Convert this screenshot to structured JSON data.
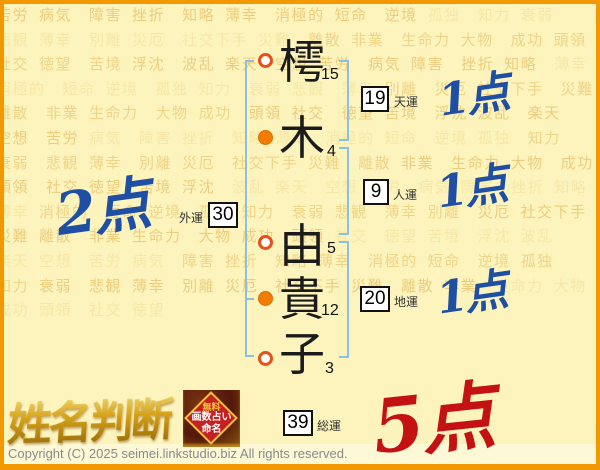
{
  "page": {
    "title": "姓名判断",
    "copyright": "Copyright (C) 2025 seimei.linkstudio.biz All rights reserved."
  },
  "name": {
    "chars": [
      {
        "char": "樗",
        "strokes": "15",
        "mark": "open",
        "group": "surname"
      },
      {
        "char": "木",
        "strokes": "4",
        "mark": "filled",
        "group": "surname"
      },
      {
        "char": "由",
        "strokes": "5",
        "mark": "open",
        "group": "given"
      },
      {
        "char": "貴",
        "strokes": "12",
        "mark": "filled",
        "group": "given"
      },
      {
        "char": "子",
        "strokes": "3",
        "mark": "open",
        "group": "given"
      }
    ]
  },
  "fortunes": [
    {
      "label": "天運",
      "value": "19",
      "score": "1点",
      "score_color": "blue"
    },
    {
      "label": "人運",
      "value": "9",
      "score": "1点",
      "score_color": "blue"
    },
    {
      "label": "外運",
      "value": "30",
      "score": "2点",
      "score_color": "blue"
    },
    {
      "label": "地運",
      "value": "20",
      "score": "1点",
      "score_color": "blue"
    },
    {
      "label": "総運",
      "value": "39",
      "score": "5点",
      "score_color": "red"
    }
  ],
  "badge": {
    "lines": [
      "無料",
      "画数占い",
      "命名"
    ]
  },
  "background_words": [
    "苦労",
    "病気",
    "障害",
    "挫折",
    "知略",
    "薄幸",
    "消極的",
    "短命",
    "逆境",
    "孤独",
    "知力",
    "衰弱",
    "悲観",
    "薄幸",
    "別離",
    "災厄",
    "社交下手",
    "災難",
    "離散",
    "非業",
    "生命力",
    "大物",
    "成功",
    "頭領",
    "社交",
    "徳望",
    "苦境",
    "浮沈",
    "波乱",
    "楽天",
    "空想"
  ],
  "colors": {
    "frame_orange": "#f39800",
    "bg": "#fcf4bc",
    "word_dark": "#eecd7f",
    "word_light": "#f6e7a8",
    "bracket_blue": "#8cc0e0",
    "circle_orange": "#f07c00",
    "ring_red": "#e4511a",
    "score_blue": "#1e4fa5",
    "score_red": "#c41212",
    "logo_gold": "#d5a118"
  }
}
